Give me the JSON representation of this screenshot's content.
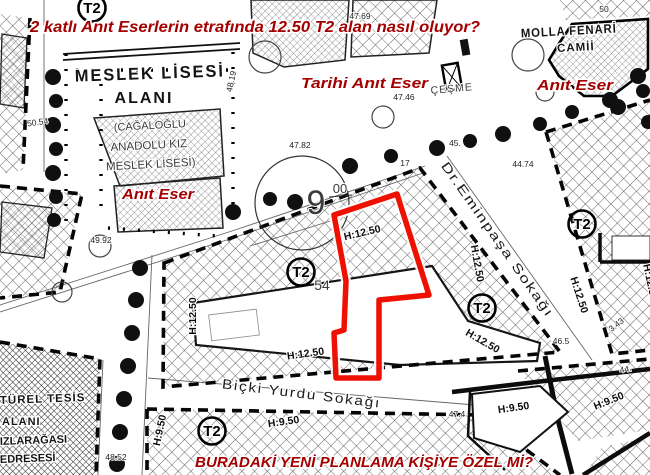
{
  "colors": {
    "annotation_red": "#a40000",
    "highlight_red": "#ee1000",
    "map_ink": "#141414",
    "background": "#ffffff"
  },
  "map": {
    "red_annotations": [
      {
        "id": "annotation-top-question",
        "text": "2 katlı Anıt Eserlerin etrafında 12.50 T2 alan nasıl oluyor?",
        "x": 30,
        "y": 32,
        "size": 16,
        "anchor": "start",
        "len": 450
      },
      {
        "id": "annotation-tarihi-anit-eser",
        "text": "Tarihi Anıt Eser",
        "x": 301,
        "y": 88,
        "size": 15,
        "anchor": "start",
        "len": 127
      },
      {
        "id": "annotation-anit-eser-right",
        "text": "Anıt Eser",
        "x": 537,
        "y": 90,
        "size": 15,
        "anchor": "start",
        "len": 76
      },
      {
        "id": "annotation-anit-eser-left",
        "text": "Anıt Eser",
        "x": 122,
        "y": 199,
        "size": 15,
        "anchor": "start",
        "len": 72
      },
      {
        "id": "annotation-bottom-question",
        "text": "BURADAKİ YENİ PLANLAMA KİŞİYE ÖZEL Mİ?",
        "x": 195,
        "y": 467,
        "size": 15,
        "anchor": "start",
        "len": 338
      }
    ],
    "area_labels": [
      {
        "id": "label-meslek-lisesi",
        "text": "MESLEK LİSESİ",
        "x": 150,
        "y": 79,
        "size": 17,
        "rot": -2,
        "ls": 2,
        "len": 150,
        "cls": "lbl"
      },
      {
        "id": "label-alani",
        "text": "ALANI",
        "x": 144,
        "y": 103,
        "size": 16,
        "ls": 2,
        "cls": "lbl"
      },
      {
        "id": "label-cagaloglu",
        "text": "(CAĞALOĞLU",
        "x": 150,
        "y": 129,
        "size": 11,
        "rot": -3,
        "cls": "lbl2"
      },
      {
        "id": "label-anadolu-kiz",
        "text": "ANADOLU KIZ",
        "x": 149,
        "y": 149,
        "size": 11.5,
        "rot": -3,
        "cls": "lbl2"
      },
      {
        "id": "label-meslek-lisesi-2",
        "text": "MESLEK LİSESİ)",
        "x": 151,
        "y": 168,
        "size": 11.5,
        "rot": -3,
        "cls": "lbl2"
      },
      {
        "id": "label-molla-fenari",
        "text": "MOLLA FENARİ",
        "x": 569,
        "y": 35,
        "size": 12.5,
        "rot": -3,
        "ls": 1,
        "len": 96,
        "cls": "lbl"
      },
      {
        "id": "label-camii",
        "text": "CAMİİ",
        "x": 576,
        "y": 51,
        "size": 11.5,
        "rot": -3,
        "ls": 1,
        "cls": "lbl"
      },
      {
        "id": "label-cesme",
        "text": "ÇEŞME",
        "x": 452,
        "y": 92,
        "size": 10.5,
        "rot": -5,
        "ls": 1,
        "cls": "lbl2"
      },
      {
        "id": "label-kulturel-tesis",
        "text": "TÜREL TESİS",
        "x": 0,
        "y": 404,
        "size": 11.5,
        "anchor": "start",
        "rot": -2,
        "ls": 1,
        "cls": "lbl"
      },
      {
        "id": "label-tesis-alani",
        "text": "ALANI",
        "x": 2,
        "y": 425,
        "size": 11,
        "anchor": "start",
        "ls": 1,
        "cls": "lbl"
      },
      {
        "id": "label-kizlaragasi",
        "text": "IZLARAĞASI",
        "x": 0,
        "y": 445,
        "size": 11,
        "anchor": "start",
        "rot": -2,
        "cls": "lbl"
      },
      {
        "id": "label-medresesi",
        "text": "EDRESESİ",
        "x": 0,
        "y": 463,
        "size": 11,
        "anchor": "start",
        "rot": -2,
        "cls": "lbl"
      },
      {
        "id": "label-parcel-54",
        "text": "54",
        "x": 322,
        "y": 290,
        "size": 14,
        "cls": "lbl2"
      }
    ],
    "street_labels": [
      {
        "id": "street-dr-eminpasa",
        "text": "Dr.Eminpaşa Sokağı",
        "x": 494,
        "y": 242,
        "size": 13,
        "rot": 55,
        "ls": 1.2,
        "len": 186,
        "cls": "street"
      },
      {
        "id": "street-bicki-yurdu",
        "text": "Biçki Yurdu Sokağı",
        "x": 301,
        "y": 398,
        "size": 13.5,
        "rot": 7,
        "ls": 1.5,
        "len": 160,
        "cls": "street"
      }
    ],
    "zone_markers": [
      {
        "id": "zone-t2-topleft",
        "label": "T2",
        "x": 92,
        "y": 8
      },
      {
        "id": "zone-t2-center-left",
        "label": "T2",
        "x": 301,
        "y": 272
      },
      {
        "id": "zone-t2-center-right",
        "label": "T2",
        "x": 482,
        "y": 308
      },
      {
        "id": "zone-t2-right",
        "label": "T2",
        "x": 582,
        "y": 224
      },
      {
        "id": "zone-t2-bottom",
        "label": "T2",
        "x": 212,
        "y": 431
      }
    ],
    "height_labels": [
      {
        "id": "height-h1250-polygon",
        "text": "H:12.50",
        "x": 363,
        "y": 236,
        "rot": -13
      },
      {
        "id": "height-h1250-left",
        "text": "H:12.50",
        "x": 196,
        "y": 316,
        "rot": -90
      },
      {
        "id": "height-h1250-center",
        "text": "H:12.50",
        "x": 306,
        "y": 357,
        "rot": -8
      },
      {
        "id": "height-h1250-east",
        "text": "H:12.50",
        "x": 474,
        "y": 264,
        "rot": 80
      },
      {
        "id": "height-h1250-right-block",
        "text": "H:12.50",
        "x": 576,
        "y": 296,
        "rot": 72
      },
      {
        "id": "height-h1250-southeast",
        "text": "H:12.50",
        "x": 481,
        "y": 344,
        "rot": 30
      },
      {
        "id": "height-h1250-edge",
        "text": "H:12.50",
        "x": 647,
        "y": 283,
        "rot": 78
      },
      {
        "id": "height-h950-left",
        "text": "H:9.50",
        "x": 163,
        "y": 431,
        "rot": -78
      },
      {
        "id": "height-h950-center",
        "text": "H:9.50",
        "x": 284,
        "y": 425,
        "rot": -8
      },
      {
        "id": "height-h950-right",
        "text": "H:9.50",
        "x": 514,
        "y": 411,
        "rot": -8
      },
      {
        "id": "height-h950-east",
        "text": "H:9.50",
        "x": 610,
        "y": 404,
        "rot": -22
      }
    ],
    "elevations": [
      {
        "id": "elev-47-69",
        "text": "47.69",
        "x": 360,
        "y": 19
      },
      {
        "id": "elev-47-46",
        "text": "47.46",
        "x": 404,
        "y": 100
      },
      {
        "id": "elev-47-82",
        "text": "47.82",
        "x": 300,
        "y": 148
      },
      {
        "id": "elev-44-74",
        "text": "44.74",
        "x": 523,
        "y": 167
      },
      {
        "id": "elev-45",
        "text": "45.",
        "x": 455,
        "y": 146
      },
      {
        "id": "elev-17",
        "text": "17",
        "x": 405,
        "y": 166
      },
      {
        "id": "elev-48-19",
        "text": "48.19",
        "x": 234,
        "y": 82,
        "rot": -78
      },
      {
        "id": "elev-49-92",
        "text": "49.92",
        "x": 101,
        "y": 243
      },
      {
        "id": "elev-50-54",
        "text": "50.54",
        "x": 38,
        "y": 125,
        "rot": -8
      },
      {
        "id": "elev-48-52",
        "text": "48.52",
        "x": 116,
        "y": 460
      },
      {
        "id": "elev-46-5",
        "text": "46.5",
        "x": 561,
        "y": 344
      },
      {
        "id": "elev-3-43",
        "text": "3.43",
        "x": 618,
        "y": 327,
        "rot": -38
      },
      {
        "id": "elev-47-4",
        "text": "47.4",
        "x": 457,
        "y": 417
      },
      {
        "id": "elev-44",
        "text": "44.",
        "x": 626,
        "y": 372,
        "rot": -10
      },
      {
        "id": "elev-50",
        "text": "50",
        "x": 604,
        "y": 12
      }
    ],
    "road_width_marker": {
      "big": "9",
      "small": "00",
      "x": 316,
      "y": 214,
      "small_x": 340,
      "small_y": 193,
      "circle_x": 302,
      "circle_y": 203,
      "circle_r": 47
    },
    "highlight_polygon": {
      "points": "334,215 397,194 429,295 379,300 379,378 336,378 334,333 344,330 346,281",
      "color": "#ee1000"
    }
  }
}
